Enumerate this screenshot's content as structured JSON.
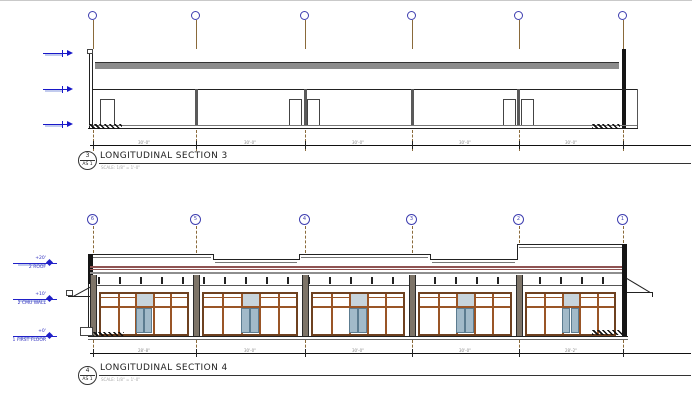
{
  "colors": {
    "grid_bubble_blue": "#3f3fb0",
    "grid_line_brown": "#8a6a3a",
    "level_blue": "#2020c8",
    "roof_deck_gray": "#8c8c8c",
    "fascia_maroon": "#8f5352",
    "storefront_brown": "#9a5526",
    "glass_blue": "#a2bac9"
  },
  "section3": {
    "tag_number": "3",
    "tag_sheet": "AS 1",
    "title": "LONGITUDINAL SECTION 3",
    "scale_note": "SCALE: 1/8\" = 1'-0\"",
    "dims": [
      "30'-0\"",
      "30'-0\"",
      "30'-0\"",
      "30'-0\"",
      "30'-0\""
    ]
  },
  "section4": {
    "tag_number": "4",
    "tag_sheet": "AS 1",
    "title": "LONGITUDINAL SECTION 4",
    "scale_note": "SCALE: 1/8\" = 1'-0\"",
    "grid_labels": [
      "6",
      "5",
      "4",
      "3",
      "2",
      "1"
    ],
    "dims": [
      "28'-8\"",
      "30'-0\"",
      "30'-0\"",
      "30'-0\"",
      "28'-2\""
    ],
    "levels": [
      {
        "elev": "+20'",
        "name": "2 ROOF"
      },
      {
        "elev": "+10'",
        "name": "2 CMU WALL"
      },
      {
        "elev": "+0'",
        "name": "1 FIRST FLOOR"
      }
    ]
  }
}
